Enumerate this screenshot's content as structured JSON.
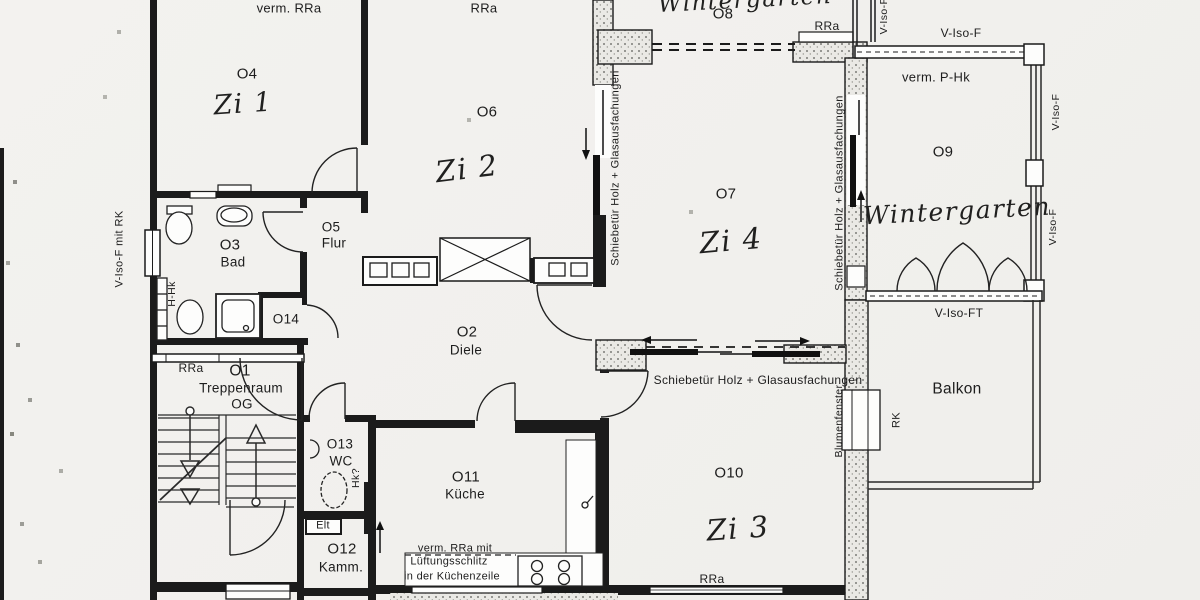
{
  "rooms": {
    "o1": {
      "number": "O1",
      "name": "Treppenraum",
      "floor": "OG",
      "window_note": "RRa"
    },
    "o2": {
      "number": "O2",
      "name": "Diele"
    },
    "o3": {
      "number": "O3",
      "name": "Bad"
    },
    "o4": {
      "number": "O4",
      "handwritten": "Zi 1",
      "top_note": "verm. RRa"
    },
    "o5": {
      "number": "O5",
      "name": "Flur"
    },
    "o6": {
      "number": "O6",
      "handwritten": "Zi 2",
      "top_note": "RRa"
    },
    "o7": {
      "number": "O7",
      "handwritten": "Zi 4"
    },
    "o8": {
      "number": "O8",
      "handwritten": "Wintergarten",
      "window_note": "RRa"
    },
    "o9": {
      "number": "O9",
      "handwritten": "Wintergarten",
      "heating_note": "verm. P-Hk"
    },
    "o10": {
      "number": "O10",
      "handwritten": "Zi 3",
      "window_note": "RRa"
    },
    "o11": {
      "number": "O11",
      "name": "Küche",
      "vent_note_line1": "verm. RRa mit",
      "vent_note_line2": "Lüftungsschlitz",
      "vent_note_line3": "in der Küchenzeile"
    },
    "o12": {
      "number": "O12",
      "name": "Kamm."
    },
    "o13": {
      "number": "O13",
      "name": "WC",
      "heating_note": "Hk?"
    },
    "o14": {
      "number": "O14"
    },
    "balkon": {
      "name": "Balkon"
    }
  },
  "annotations": {
    "sliding_door": "Schiebetür Holz + Glasausfachungen",
    "v_iso_f": "V-Iso-F",
    "v_iso_ft": "V-Iso-FT",
    "v_iso_f_mit_rk": "V-Iso-F mit RK",
    "blumenfenster": "Blumenfenster",
    "rk": "RK",
    "h_hk": "H-Hk",
    "elt": "Elt"
  },
  "colors": {
    "paper": "#f2f1ee",
    "ink": "#1b1b1b"
  }
}
